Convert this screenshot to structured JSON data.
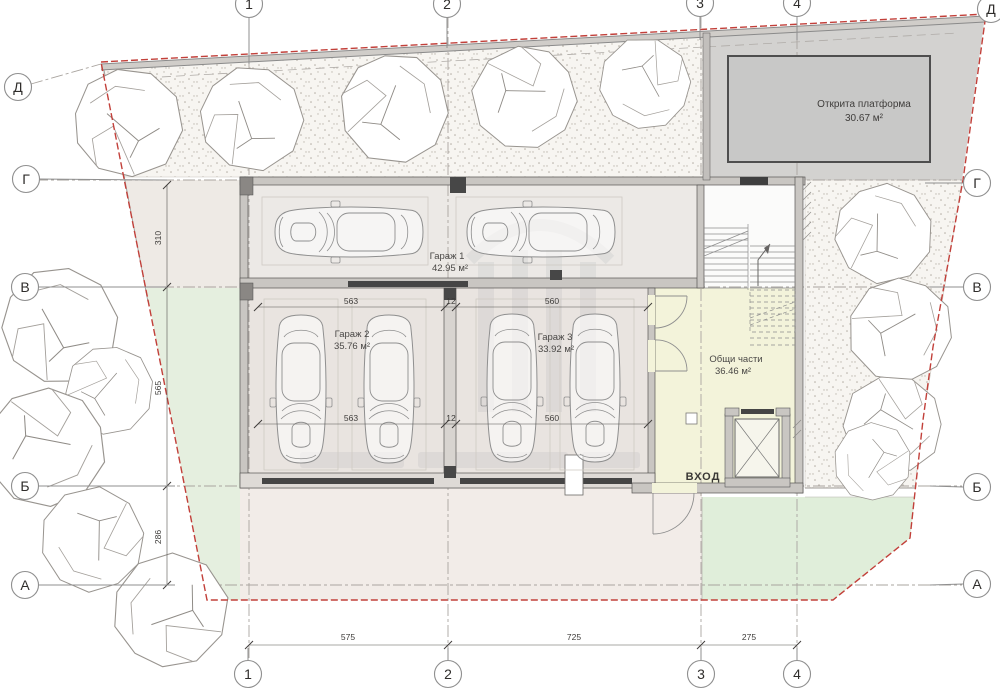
{
  "plan": {
    "rooms": {
      "garage1": {
        "name": "Гараж 1",
        "area": "42.95 м²"
      },
      "garage2": {
        "name": "Гараж 2",
        "area": "35.76 м²"
      },
      "garage3": {
        "name": "Гараж 3",
        "area": "33.92 м²"
      },
      "common": {
        "name": "Общи части",
        "area": "36.46 м²"
      },
      "platform": {
        "name": "Открита платформа",
        "area": "30.67 м²"
      }
    },
    "entrance_label": "ВХОД",
    "grid": {
      "rows": [
        "Д",
        "Г",
        "В",
        "Б",
        "А"
      ],
      "cols": [
        "1",
        "2",
        "3",
        "4"
      ]
    },
    "dims": {
      "left": [
        "310",
        "565",
        "286"
      ],
      "bottom": [
        "575",
        "725",
        "275"
      ],
      "garage_top": [
        "563",
        "12",
        "560"
      ],
      "garage_bottom": [
        "563",
        "12",
        "560"
      ]
    },
    "colors": {
      "boundary_red": "#c2403a",
      "common_yellow": "#f3f3da",
      "lawn_green": "#e3eedd",
      "platform_gray": "#c8c8c7",
      "garage_floor": "#ece9e6",
      "wall_gray": "#c9c6c2"
    }
  }
}
